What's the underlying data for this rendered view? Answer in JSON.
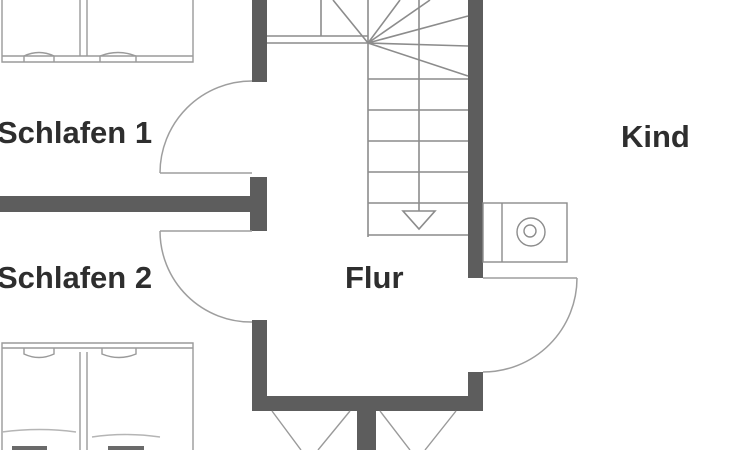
{
  "floorplan": {
    "type": "architectural-floor-plan",
    "rooms": [
      {
        "id": "schlafen1",
        "label": "Schlafen 1"
      },
      {
        "id": "schlafen2",
        "label": "Schlafen 2"
      },
      {
        "id": "flur",
        "label": "Flur"
      },
      {
        "id": "kind",
        "label": "Kind"
      }
    ],
    "symbols": [
      "winder-staircase",
      "stair-walk-line",
      "stair-direction-arrow",
      "door-swing-schlafen1",
      "door-swing-schlafen2",
      "door-swing-kind",
      "double-bed-schlafen1",
      "double-bed-schlafen2",
      "chimney-fixture",
      "window-casement-left",
      "window-casement-right"
    ],
    "colors": {
      "background": "#ffffff",
      "wall": "#5d5d5d",
      "thin_line": "#8c8c8c",
      "door_arc": "#9e9e9e",
      "furniture": "#9a9a9a",
      "text": "#2e2e2e"
    }
  }
}
